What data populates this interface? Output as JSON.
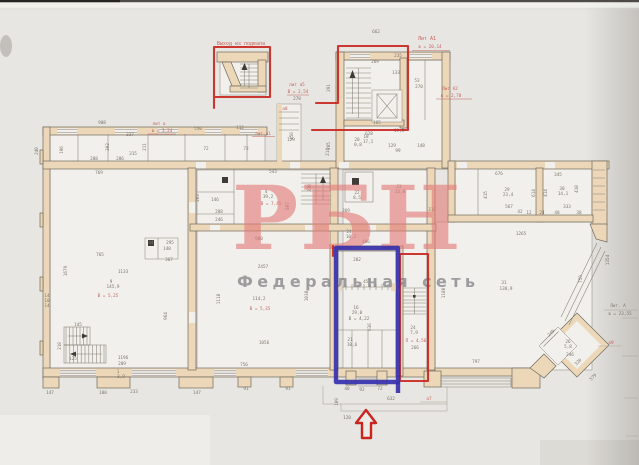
{
  "watermark": {
    "title": "РБН",
    "subtitle": "Федеральная сеть",
    "title_color": "rgba(226,122,120,0.62)",
    "subtitle_color": "rgba(128,130,134,0.75)"
  },
  "annotations": {
    "marker_red": "#c9241f",
    "marker_blue": "#3531ae",
    "print_red": "#c4625c",
    "boxes": [
      {
        "name": "basement-exit-box",
        "color": "red",
        "label": "Выход из подвала"
      },
      {
        "name": "main-staircase-box",
        "color": "red"
      },
      {
        "name": "inner-staircase-box",
        "color": "red"
      },
      {
        "name": "blue-room-box",
        "color": "blue"
      }
    ],
    "arrow": {
      "direction": "up",
      "color": "red"
    }
  },
  "plan": {
    "palette": {
      "wall_fill": "#ecd8b8",
      "line_color": "#6f695f",
      "paper": "#e8e6e2"
    },
    "labels": [
      {
        "t": "Выход из подвала",
        "x": 241,
        "y": 45,
        "c": "r",
        "s": 5
      },
      {
        "t": "662",
        "x": 376,
        "y": 33
      },
      {
        "t": "Лит А1",
        "x": 427,
        "y": 40,
        "c": "r",
        "s": 5
      },
      {
        "t": "в = 20,14",
        "x": 430,
        "y": 48,
        "c": "r"
      },
      {
        "t": "270",
        "x": 419,
        "y": 88
      },
      {
        "t": "Лит А2",
        "x": 450,
        "y": 90,
        "c": "r"
      },
      {
        "t": "в = 2,78",
        "x": 451,
        "y": 97,
        "c": "r"
      },
      {
        "t": "лит а5",
        "x": 297,
        "y": 86,
        "c": "r"
      },
      {
        "t": "В = 2,54",
        "x": 298,
        "y": 93,
        "c": "r"
      },
      {
        "t": "278",
        "x": 297,
        "y": 100
      },
      {
        "t": "а8",
        "x": 285,
        "y": 110,
        "c": "r"
      },
      {
        "t": "908",
        "x": 102,
        "y": 124
      },
      {
        "t": "лит а",
        "x": 159,
        "y": 125,
        "c": "r"
      },
      {
        "t": "в = 3,24",
        "x": 162,
        "y": 132,
        "c": "r"
      },
      {
        "t": "550",
        "x": 198,
        "y": 130
      },
      {
        "t": "112",
        "x": 240,
        "y": 129
      },
      {
        "t": "лит.а1",
        "x": 263,
        "y": 135,
        "c": "r"
      },
      {
        "t": "129",
        "x": 291,
        "y": 141
      },
      {
        "t": "72",
        "x": 206,
        "y": 150
      },
      {
        "t": "73",
        "x": 246,
        "y": 150
      },
      {
        "t": "240",
        "x": 38,
        "y": 151,
        "rot": -90
      },
      {
        "t": "196",
        "x": 63,
        "y": 150,
        "rot": -90
      },
      {
        "t": "288",
        "x": 94,
        "y": 160
      },
      {
        "t": "286",
        "x": 120,
        "y": 160
      },
      {
        "t": "315",
        "x": 133,
        "y": 155
      },
      {
        "t": "302",
        "x": 109,
        "y": 147,
        "rot": -90
      },
      {
        "t": "337",
        "x": 130,
        "y": 136
      },
      {
        "t": "211",
        "x": 146,
        "y": 147,
        "rot": -90
      },
      {
        "t": "456",
        "x": 293,
        "y": 136,
        "rot": -90
      },
      {
        "t": "214",
        "x": 329,
        "y": 152,
        "rot": -90
      },
      {
        "t": "769",
        "x": 99,
        "y": 174
      },
      {
        "t": "543",
        "x": 273,
        "y": 173
      },
      {
        "t": "148",
        "x": 421,
        "y": 147
      },
      {
        "t": "99",
        "x": 398,
        "y": 152
      },
      {
        "t": "22",
        "x": 357,
        "y": 194
      },
      {
        "t": "8,5",
        "x": 357,
        "y": 199
      },
      {
        "t": "23",
        "x": 399,
        "y": 188
      },
      {
        "t": "13,8",
        "x": 400,
        "y": 193
      },
      {
        "t": "369",
        "x": 346,
        "y": 212
      },
      {
        "t": "315",
        "x": 432,
        "y": 211
      },
      {
        "t": "24",
        "x": 349,
        "y": 233
      },
      {
        "t": "10,2",
        "x": 351,
        "y": 238
      },
      {
        "t": "486",
        "x": 366,
        "y": 243
      },
      {
        "t": "4",
        "x": 266,
        "y": 193
      },
      {
        "t": "39,2",
        "x": 268,
        "y": 198
      },
      {
        "t": "В = 7,45",
        "x": 271,
        "y": 205,
        "c": "r"
      },
      {
        "t": "278",
        "x": 311,
        "y": 188,
        "rot": -90
      },
      {
        "t": "607",
        "x": 289,
        "y": 206,
        "rot": -90
      },
      {
        "t": "203",
        "x": 199,
        "y": 198,
        "rot": -90
      },
      {
        "t": "146",
        "x": 215,
        "y": 201
      },
      {
        "t": "288",
        "x": 219,
        "y": 213
      },
      {
        "t": "246",
        "x": 219,
        "y": 221
      },
      {
        "t": "980",
        "x": 259,
        "y": 240
      },
      {
        "t": "44",
        "x": 151,
        "y": 244
      },
      {
        "t": "295",
        "x": 170,
        "y": 244
      },
      {
        "t": "140",
        "x": 167,
        "y": 250
      },
      {
        "t": "367",
        "x": 169,
        "y": 261
      },
      {
        "t": "765",
        "x": 100,
        "y": 256
      },
      {
        "t": "1133",
        "x": 123,
        "y": 273
      },
      {
        "t": "9",
        "x": 111,
        "y": 283
      },
      {
        "t": "145,9",
        "x": 113,
        "y": 288
      },
      {
        "t": "В = 5,25",
        "x": 108,
        "y": 297,
        "c": "r"
      },
      {
        "t": "1679",
        "x": 67,
        "y": 271,
        "rot": -90
      },
      {
        "t": "964",
        "x": 167,
        "y": 316,
        "rot": -90
      },
      {
        "t": "145",
        "x": 78,
        "y": 326
      },
      {
        "t": "125",
        "x": 73,
        "y": 360
      },
      {
        "t": "218",
        "x": 61,
        "y": 346,
        "rot": -90
      },
      {
        "t": "2457",
        "x": 263,
        "y": 268
      },
      {
        "t": "114,2",
        "x": 259,
        "y": 300
      },
      {
        "t": "В = 5,35",
        "x": 260,
        "y": 310,
        "c": "r"
      },
      {
        "t": "1056",
        "x": 264,
        "y": 344
      },
      {
        "t": "1118",
        "x": 220,
        "y": 299,
        "rot": -90
      },
      {
        "t": "1038",
        "x": 308,
        "y": 296,
        "rot": -90
      },
      {
        "t": "147",
        "x": 50,
        "y": 394
      },
      {
        "t": "100",
        "x": 103,
        "y": 394
      },
      {
        "t": "233",
        "x": 134,
        "y": 393
      },
      {
        "t": "147",
        "x": 197,
        "y": 394
      },
      {
        "t": "1196",
        "x": 123,
        "y": 359
      },
      {
        "t": "209",
        "x": 122,
        "y": 365
      },
      {
        "t": "1",
        "x": 118,
        "y": 373
      },
      {
        "t": "3,9",
        "x": 121,
        "y": 378
      },
      {
        "t": "756",
        "x": 244,
        "y": 366
      },
      {
        "t": "91",
        "x": 246,
        "y": 390
      },
      {
        "t": "91",
        "x": 288,
        "y": 390
      },
      {
        "t": "676",
        "x": 499,
        "y": 175
      },
      {
        "t": "345",
        "x": 558,
        "y": 176
      },
      {
        "t": "29",
        "x": 507,
        "y": 191
      },
      {
        "t": "23,4",
        "x": 508,
        "y": 196
      },
      {
        "t": "30",
        "x": 562,
        "y": 190
      },
      {
        "t": "14,1",
        "x": 563,
        "y": 195
      },
      {
        "t": "415",
        "x": 487,
        "y": 195,
        "rot": -90
      },
      {
        "t": "614",
        "x": 535,
        "y": 193,
        "rot": -90
      },
      {
        "t": "414",
        "x": 547,
        "y": 193,
        "rot": -90
      },
      {
        "t": "418",
        "x": 578,
        "y": 189,
        "rot": -90
      },
      {
        "t": "567",
        "x": 509,
        "y": 208
      },
      {
        "t": "42",
        "x": 520,
        "y": 213
      },
      {
        "t": "12",
        "x": 529,
        "y": 214
      },
      {
        "t": "24",
        "x": 542,
        "y": 214
      },
      {
        "t": "40",
        "x": 557,
        "y": 214
      },
      {
        "t": "38",
        "x": 579,
        "y": 214
      },
      {
        "t": "333",
        "x": 567,
        "y": 208
      },
      {
        "t": "1265",
        "x": 521,
        "y": 235
      },
      {
        "t": "31",
        "x": 504,
        "y": 284
      },
      {
        "t": "138,9",
        "x": 506,
        "y": 290
      },
      {
        "t": "1180",
        "x": 445,
        "y": 293,
        "rot": -90
      },
      {
        "t": "797",
        "x": 476,
        "y": 363
      },
      {
        "t": "249",
        "x": 552,
        "y": 334,
        "rot": -45
      },
      {
        "t": "26",
        "x": 568,
        "y": 343
      },
      {
        "t": "5,8",
        "x": 568,
        "y": 348
      },
      {
        "t": "246",
        "x": 570,
        "y": 356
      },
      {
        "t": "320",
        "x": 579,
        "y": 363,
        "rot": -45
      },
      {
        "t": "579",
        "x": 594,
        "y": 378,
        "rot": -45
      },
      {
        "t": "а9",
        "x": 611,
        "y": 344,
        "c": "r"
      },
      {
        "t": "Лит. А",
        "x": 618,
        "y": 307
      },
      {
        "t": "в = 23,55",
        "x": 620,
        "y": 315
      },
      {
        "t": "759",
        "x": 582,
        "y": 279,
        "rot": -90
      },
      {
        "t": "1354",
        "x": 609,
        "y": 260,
        "rot": -90
      },
      {
        "t": "632",
        "x": 391,
        "y": 400
      },
      {
        "t": "120",
        "x": 347,
        "y": 419
      },
      {
        "t": "а7",
        "x": 429,
        "y": 400,
        "c": "r"
      },
      {
        "t": "109",
        "x": 338,
        "y": 402,
        "rot": -90
      },
      {
        "t": "202",
        "x": 357,
        "y": 261
      },
      {
        "t": "457",
        "x": 367,
        "y": 283
      },
      {
        "t": "16",
        "x": 356,
        "y": 309
      },
      {
        "t": "29,0",
        "x": 357,
        "y": 314
      },
      {
        "t": "В = 4,22",
        "x": 359,
        "y": 320
      },
      {
        "t": "636",
        "x": 371,
        "y": 327,
        "rot": -90
      },
      {
        "t": "21",
        "x": 350,
        "y": 341
      },
      {
        "t": "10,6",
        "x": 352,
        "y": 346
      },
      {
        "t": "40",
        "x": 347,
        "y": 390
      },
      {
        "t": "92",
        "x": 362,
        "y": 391
      },
      {
        "t": "72",
        "x": 380,
        "y": 390
      },
      {
        "t": "24",
        "x": 413,
        "y": 329
      },
      {
        "t": "7,9",
        "x": 414,
        "y": 334
      },
      {
        "t": "П = 4,56",
        "x": 416,
        "y": 342,
        "c": "r"
      },
      {
        "t": "266",
        "x": 415,
        "y": 349
      },
      {
        "t": "269",
        "x": 375,
        "y": 63
      },
      {
        "t": "235",
        "x": 398,
        "y": 57
      },
      {
        "t": "133",
        "x": 396,
        "y": 74
      },
      {
        "t": "53",
        "x": 417,
        "y": 82
      },
      {
        "t": "165",
        "x": 377,
        "y": 124
      },
      {
        "t": "18",
        "x": 366,
        "y": 138
      },
      {
        "t": "17,1",
        "x": 368,
        "y": 143
      },
      {
        "t": "19,5",
        "x": 399,
        "y": 132
      },
      {
        "t": "291",
        "x": 330,
        "y": 88,
        "rot": -90
      },
      {
        "t": "628",
        "x": 369,
        "y": 135
      },
      {
        "t": "205",
        "x": 330,
        "y": 146,
        "rot": -90
      },
      {
        "t": "20",
        "x": 357,
        "y": 141
      },
      {
        "t": "0,8",
        "x": 358,
        "y": 146
      },
      {
        "t": "129",
        "x": 392,
        "y": 147
      },
      {
        "t": "14",
        "x": 47,
        "y": 297
      },
      {
        "t": "10",
        "x": 47,
        "y": 302
      },
      {
        "t": "14",
        "x": 47,
        "y": 307
      }
    ]
  }
}
